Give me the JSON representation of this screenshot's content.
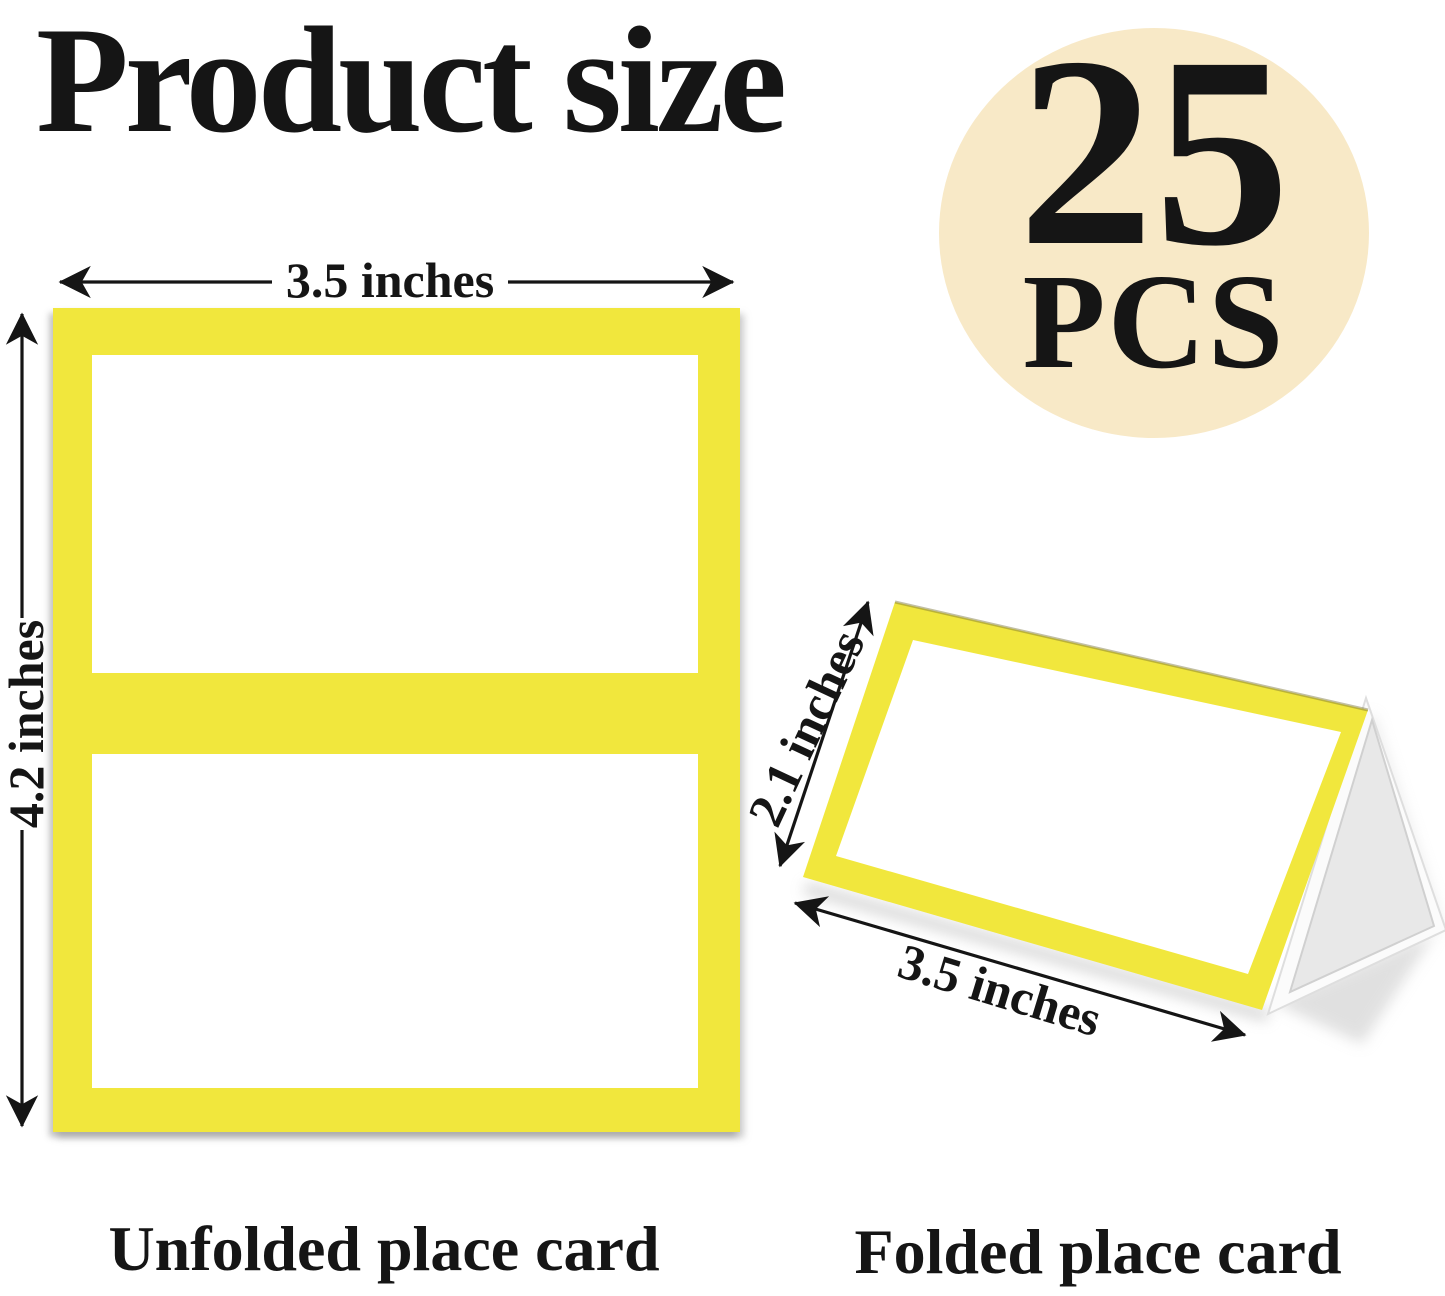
{
  "title": "Product size",
  "badge": {
    "count": "25",
    "unit": "PCS"
  },
  "unfolded": {
    "width_label": "3.5 inches",
    "height_label": "4.2 inches",
    "caption": "Unfolded place card"
  },
  "folded": {
    "height_label": "2.1 inches",
    "width_label": "3.5 inches",
    "caption": "Folded place card"
  },
  "colors": {
    "yellow": "#F1E73D",
    "cream": "#F8E9C7",
    "card_white": "#FFFFFF",
    "back_gray": "#E8E8E8",
    "ink": "#151515"
  }
}
